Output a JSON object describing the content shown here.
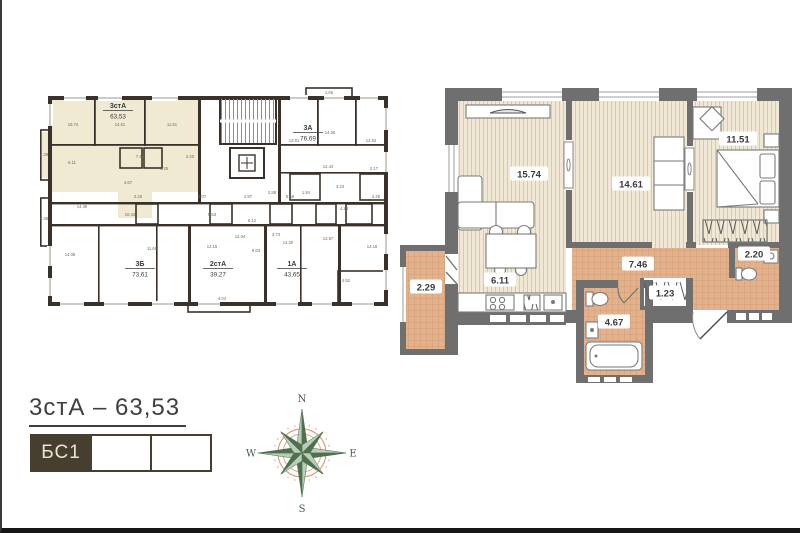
{
  "title": {
    "text": "3стА – 63,53"
  },
  "selector": {
    "cells": [
      {
        "label": "БС1",
        "active": true
      },
      {
        "label": "",
        "active": false
      },
      {
        "label": "",
        "active": false
      }
    ]
  },
  "compass": {
    "n": "N",
    "s": "S",
    "e": "E",
    "w": "W"
  },
  "colors": {
    "highlight": "#f1ead3",
    "overview_wall": "#3a322a",
    "detail_wall": "#6f6f6f",
    "wood_floor": "#f0e8d4",
    "tile_floor": "#e3b28c",
    "selector_dark": "#463e2f",
    "compass_green": "#4e7050",
    "compass_salmon": "#dd9f7d"
  },
  "overview": {
    "apartments": [
      {
        "name": "3стА",
        "area": "63,53",
        "x": 78,
        "y": 22
      },
      {
        "name": "3А",
        "area": "76,69",
        "x": 268,
        "y": 44
      },
      {
        "name": "3Б",
        "area": "73,61",
        "x": 100,
        "y": 180
      },
      {
        "name": "2стА",
        "area": "39,27",
        "x": 178,
        "y": 180
      },
      {
        "name": "1А",
        "area": "43,65",
        "x": 252,
        "y": 180
      }
    ],
    "room_labels": [
      {
        "t": "15.74",
        "x": 33,
        "y": 40
      },
      {
        "t": "14.61",
        "x": 80,
        "y": 40
      },
      {
        "t": "11.51",
        "x": 132,
        "y": 40
      },
      {
        "t": "6.11",
        "x": 32,
        "y": 78
      },
      {
        "t": "7.46",
        "x": 100,
        "y": 72
      },
      {
        "t": "1.25",
        "x": 124,
        "y": 84
      },
      {
        "t": "2.20",
        "x": 150,
        "y": 72
      },
      {
        "t": "4.67",
        "x": 88,
        "y": 98
      },
      {
        "t": "2.29",
        "x": 4,
        "y": 70
      },
      {
        "t": "2.36",
        "x": 4,
        "y": 134
      },
      {
        "t": "1.65",
        "x": 289,
        "y": 8
      },
      {
        "t": "13.61",
        "x": 254,
        "y": 56
      },
      {
        "t": "14.06",
        "x": 290,
        "y": 48
      },
      {
        "t": "12.52",
        "x": 331,
        "y": 56
      },
      {
        "t": "12.44",
        "x": 288,
        "y": 82
      },
      {
        "t": "2.17",
        "x": 334,
        "y": 84
      },
      {
        "t": "3.23",
        "x": 300,
        "y": 102
      },
      {
        "t": "1.84",
        "x": 266,
        "y": 108
      },
      {
        "t": "4.48",
        "x": 336,
        "y": 112
      },
      {
        "t": "4.23",
        "x": 304,
        "y": 124
      },
      {
        "t": "2.88",
        "x": 232,
        "y": 108
      },
      {
        "t": "5.68",
        "x": 250,
        "y": 112
      },
      {
        "t": "14.49",
        "x": 42,
        "y": 122
      },
      {
        "t": "10.44",
        "x": 90,
        "y": 130
      },
      {
        "t": "2.26",
        "x": 98,
        "y": 112
      },
      {
        "t": "2.07",
        "x": 162,
        "y": 112
      },
      {
        "t": "5.63",
        "x": 172,
        "y": 130
      },
      {
        "t": "4.87",
        "x": 208,
        "y": 112
      },
      {
        "t": "12.04",
        "x": 200,
        "y": 152
      },
      {
        "t": "6.12",
        "x": 212,
        "y": 136
      },
      {
        "t": "9.63",
        "x": 216,
        "y": 166
      },
      {
        "t": "3.73",
        "x": 236,
        "y": 150
      },
      {
        "t": "14.08",
        "x": 30,
        "y": 170
      },
      {
        "t": "11.69",
        "x": 112,
        "y": 164
      },
      {
        "t": "12.15",
        "x": 172,
        "y": 162
      },
      {
        "t": "14.20",
        "x": 248,
        "y": 158
      },
      {
        "t": "13.57",
        "x": 288,
        "y": 154
      },
      {
        "t": "14.18",
        "x": 332,
        "y": 162
      },
      {
        "t": "4.52",
        "x": 306,
        "y": 196
      },
      {
        "t": "4.04",
        "x": 182,
        "y": 214
      }
    ]
  },
  "detail": {
    "room_labels": [
      {
        "t": "15.74",
        "x": 139,
        "y": 92
      },
      {
        "t": "14.61",
        "x": 241,
        "y": 102
      },
      {
        "t": "11.51",
        "x": 348,
        "y": 57
      },
      {
        "t": "2.29",
        "x": 36,
        "y": 205
      },
      {
        "t": "6.11",
        "x": 110,
        "y": 198
      },
      {
        "t": "7.46",
        "x": 248,
        "y": 182
      },
      {
        "t": "1.23",
        "x": 275,
        "y": 211
      },
      {
        "t": "4.67",
        "x": 224,
        "y": 240
      },
      {
        "t": "2.20",
        "x": 364,
        "y": 172
      }
    ]
  }
}
